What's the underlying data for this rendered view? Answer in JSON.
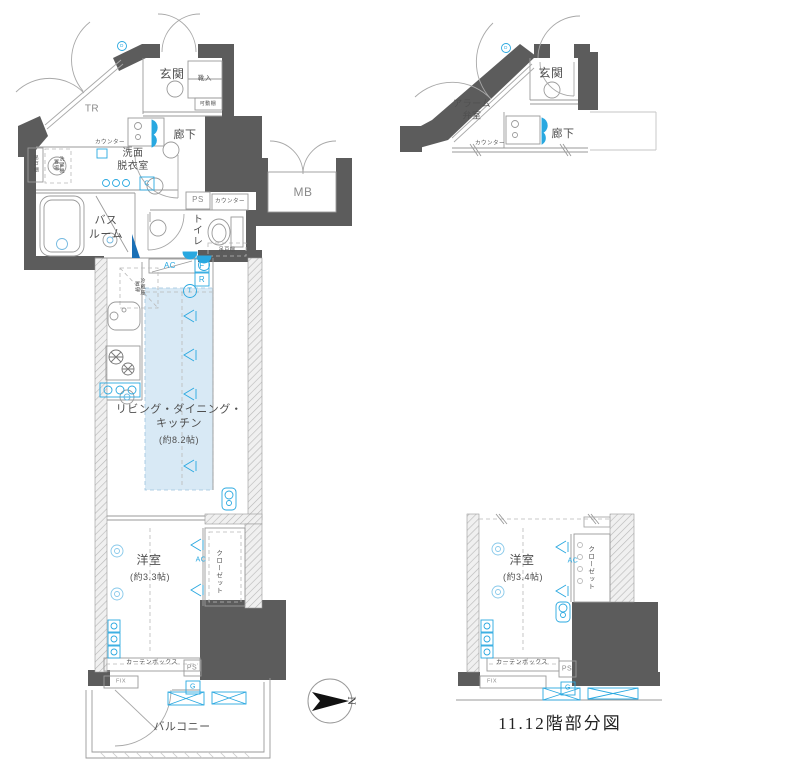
{
  "meta": {
    "type": "japanese-apartment-floor-plan"
  },
  "colors": {
    "wall": "#5c5c5c",
    "thin_line": "#9a9a9a",
    "accent_blue": "#29a8e0",
    "ldk_fill": "#d8e9f5",
    "text": "#4f4f4f"
  },
  "main": {
    "labels": {
      "tr": "TR",
      "genkan": "玄関",
      "shoe": "靴入",
      "shelf": "可動棚",
      "corridor": "廊下",
      "counter_wash": "カウンター",
      "washroom": "洗面\n脱衣室",
      "cupboard_left": "吊戸棚",
      "washer": "洗濯機\n置場",
      "bathroom": "バス\nルーム",
      "ps_upper": "PS",
      "counter_toilet": "カウンター",
      "toilet": "トイレ",
      "cupboard_toilet": "吊戸棚",
      "mb": "MB",
      "ac_kitchen": "AC",
      "sym_f": "F",
      "sym_r": "R",
      "sym_t": "T",
      "sym_c": "C",
      "sym_d": "D",
      "fridge": "冷蔵庫\n置場",
      "ldk": "リビング・ダイニング・\nキッチン",
      "ldk_size": "(約8.2帖)",
      "bedroom": "洋室",
      "bedroom_size": "(約3.3帖)",
      "closet": "クローゼット",
      "ac_bedroom": "AC",
      "curtain": "カーテンボックス",
      "ps_lower": "PS",
      "fix": "FIX",
      "sym_g": "G",
      "balcony": "バルコニー"
    }
  },
  "partial": {
    "caption": "11.12階部分図",
    "labels": {
      "alarm": "アラーム\n弁室",
      "genkan": "玄関",
      "corridor": "廊下",
      "counter": "カウンター",
      "sym_d": "D",
      "bedroom": "洋室",
      "bedroom_size": "(約3.4帖)",
      "closet": "クローゼット",
      "ac": "AC",
      "curtain": "カーテンボックス",
      "ps": "PS",
      "fix": "FIX",
      "sym_g": "G"
    }
  },
  "compass": {
    "letter": "N"
  }
}
